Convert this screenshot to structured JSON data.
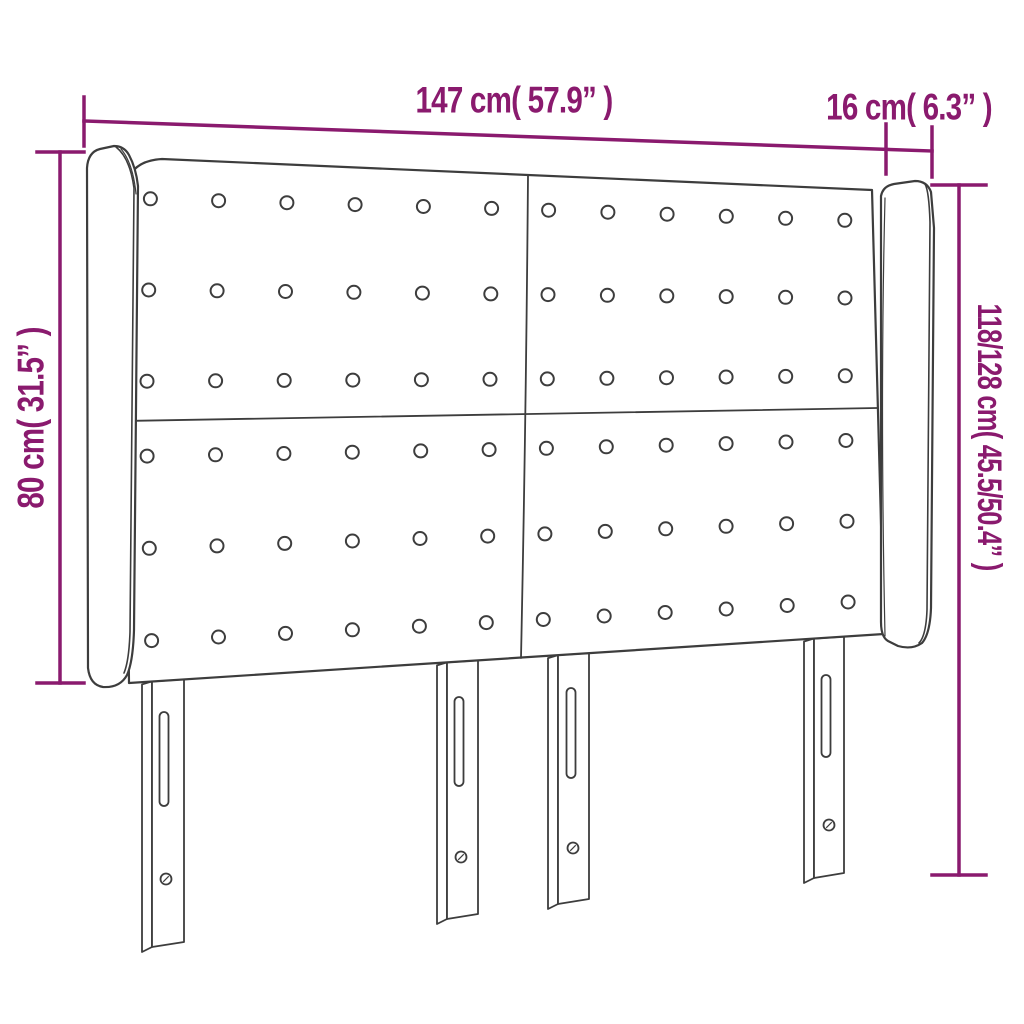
{
  "meta": {
    "type": "product-dimension-diagram",
    "product": "winged headboard with tufted buttons and adjustable legs",
    "background": "#ffffff"
  },
  "colors": {
    "dimension": "#8a1a6e",
    "line_art": "#3d3d3d",
    "fill": "#ffffff"
  },
  "dimensions": {
    "width": {
      "label": "147 cm( 57.9” )"
    },
    "depth": {
      "label": "16 cm( 6.3” )"
    },
    "height_board": {
      "label": "80 cm( 31.5” )"
    },
    "height_total": {
      "label": "118/128 cm( 45.5/50.4” )"
    }
  },
  "headboard": {
    "panels": 4,
    "tufting": {
      "rows_per_panel": 3,
      "cols_per_panel": 6,
      "total_buttons": 72
    },
    "wings": 2,
    "legs": {
      "count": 4,
      "slots_per_leg": 1,
      "screw_holes_per_leg": 1
    }
  }
}
